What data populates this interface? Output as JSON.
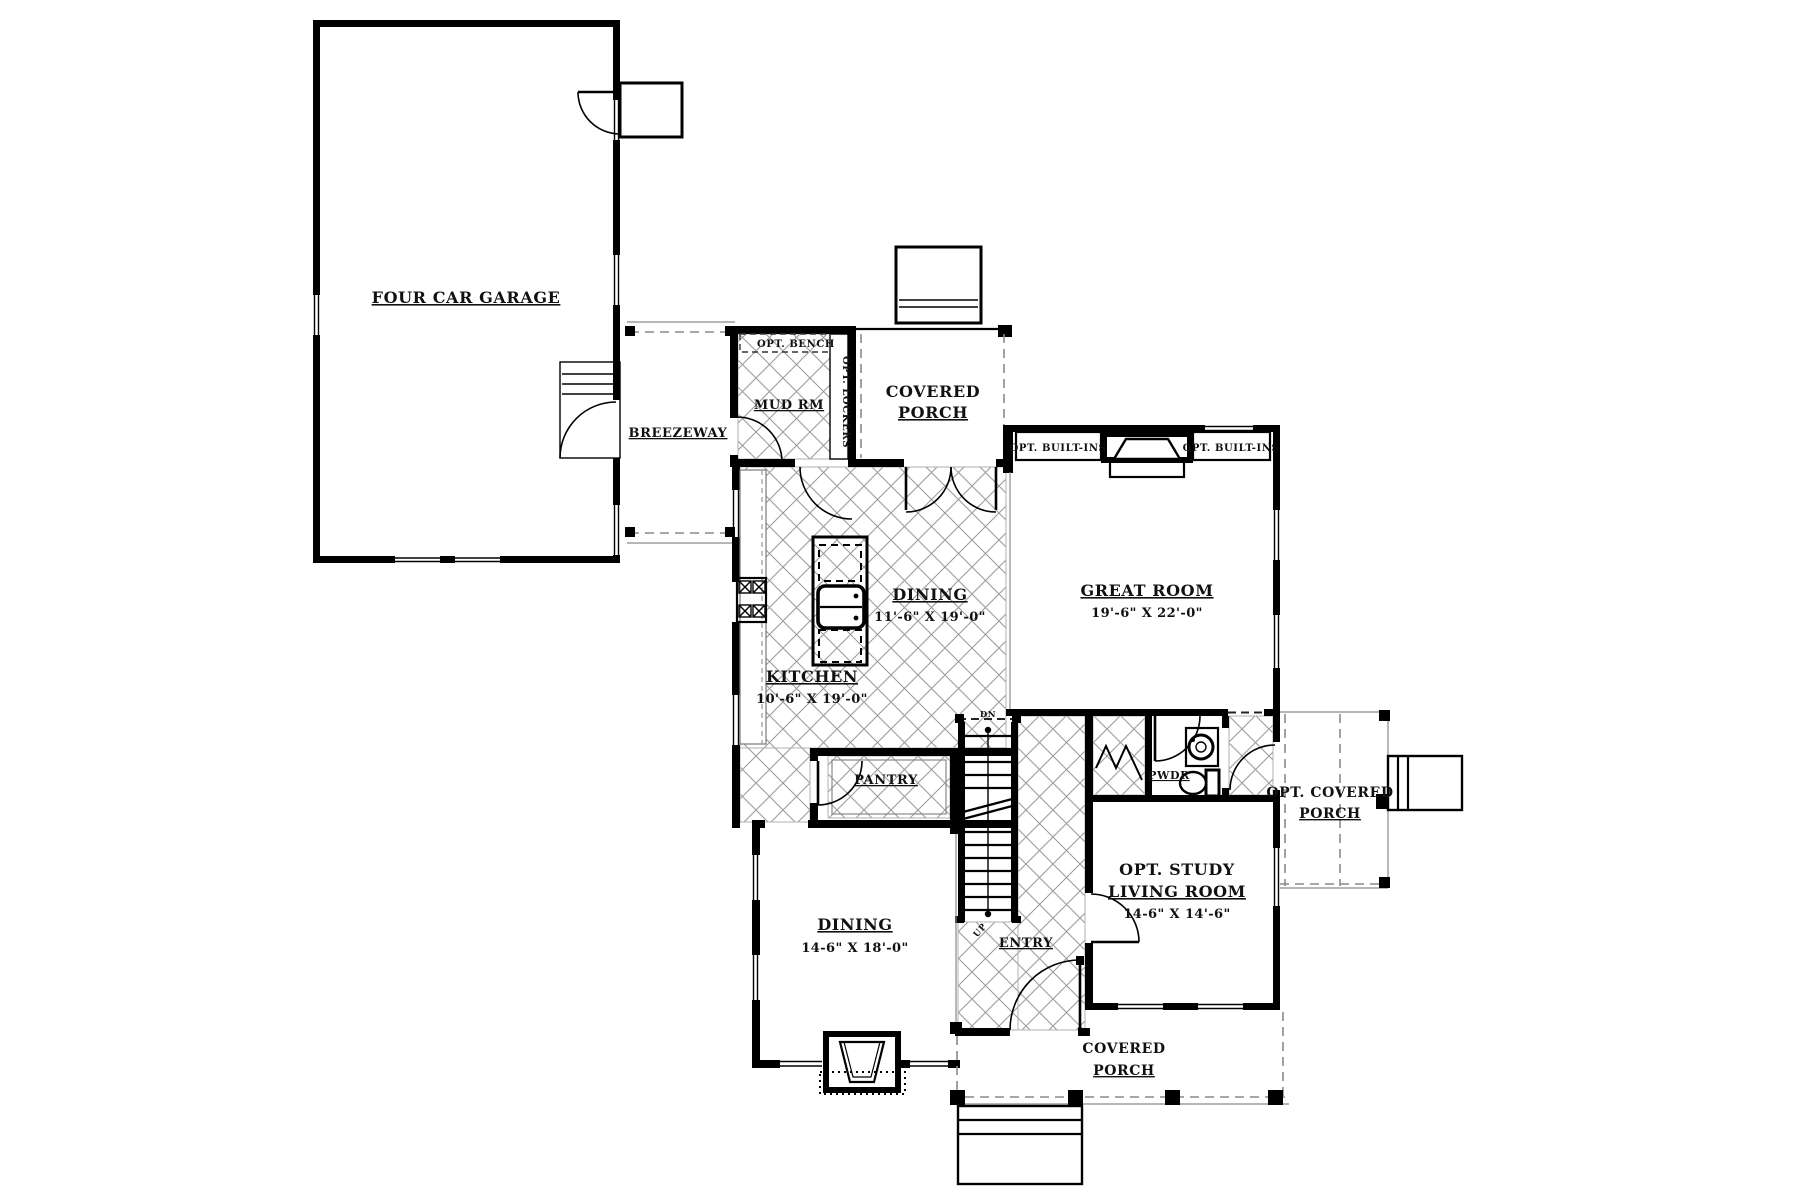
{
  "document": {
    "type": "architectural-first-floor-plan"
  },
  "colors": {
    "wall": "#000000",
    "hatch_line": "#9c9c9c",
    "dashed_line": "#8a8a8a",
    "paper": "#ffffff"
  },
  "rooms": {
    "garage": {
      "name": "FOUR CAR GARAGE"
    },
    "breezeway": {
      "name": "BREEZEWAY"
    },
    "mud_room": {
      "name": "MUD RM",
      "bench_note": "OPT. BENCH",
      "lockers_note": "OPT. LOCKERS"
    },
    "covered_porch_top": {
      "name_line1": "COVERED",
      "name_line2": "PORCH"
    },
    "great_room": {
      "name": "GREAT ROOM",
      "dims": "19'-6\" X 22'-0\"",
      "built_ins_left": "OPT. BUILT-INS",
      "built_ins_right": "OPT. BUILT-INS"
    },
    "dining_nook": {
      "name": "DINING",
      "dims": "11'-6\" X 19'-0\""
    },
    "kitchen": {
      "name": "KITCHEN",
      "dims": "10'-6\" X 19'-0\""
    },
    "pantry": {
      "name": "PANTRY"
    },
    "powder": {
      "name": "PWDR"
    },
    "entry": {
      "name": "ENTRY"
    },
    "study": {
      "name_line1": "OPT. STUDY",
      "name_line2": "LIVING ROOM",
      "dims": "14-6\" X 14'-6\""
    },
    "dining_formal": {
      "name": "DINING",
      "dims": "14-6\" X 18'-0\""
    },
    "opt_covered_porch": {
      "name_line1": "OPT. COVERED",
      "name_line2": "PORCH"
    },
    "covered_porch_bottom": {
      "name_line1": "COVERED",
      "name_line2": "PORCH"
    },
    "stairs": {
      "down_label": "DN",
      "up_label": "UP"
    }
  }
}
